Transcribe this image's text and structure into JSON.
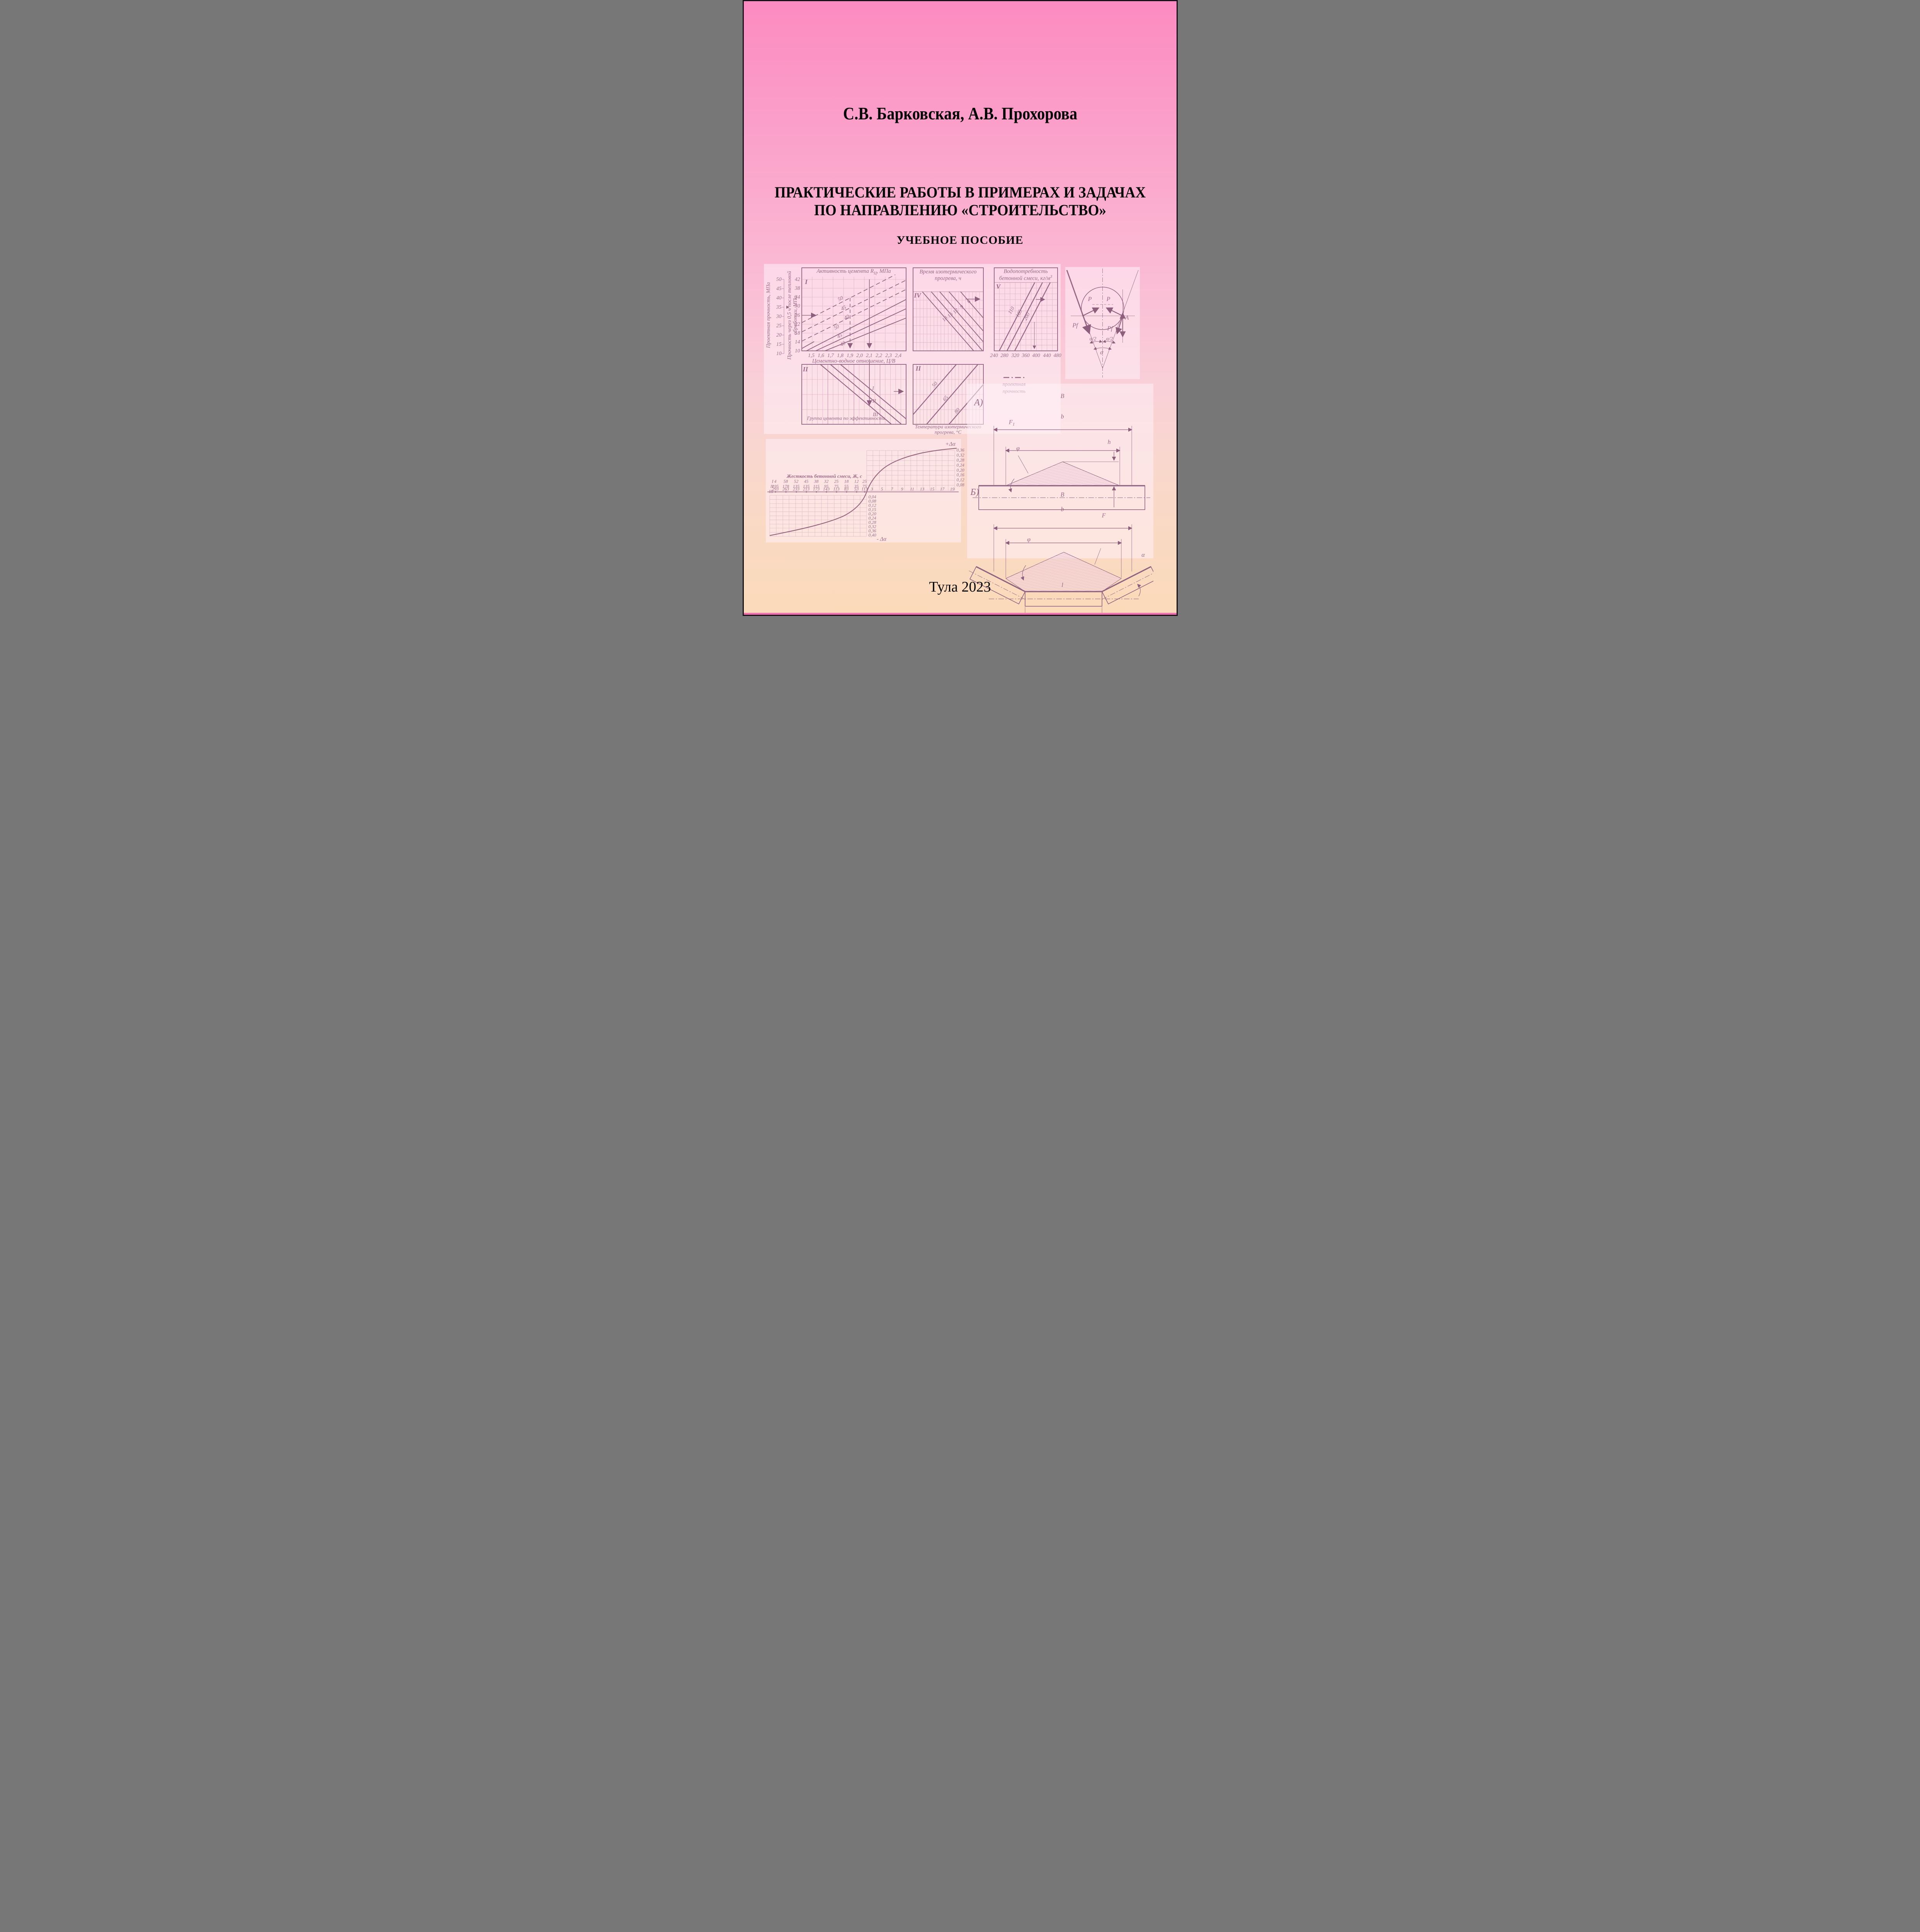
{
  "page": {
    "authors": "С.В. Барковская, А.В. Прохорова",
    "title1": "ПРАКТИЧЕСКИЕ РАБОТЫ В ПРИМЕРАХ И ЗАДАЧАХ",
    "title2": "ПО НАПРАВЛЕНИЮ «СТРОИТЕЛЬСТВО»",
    "subtitle": "УЧЕБНОЕ ПОСОБИЕ",
    "imprint": "Тула 2023"
  },
  "nomogram": {
    "title_activity_pre": "Активность цемента R",
    "title_activity_sub": "Ц",
    "title_activity_post": ", МПа",
    "axis_design_strength": "Проектная прочность, МПа",
    "axis_heat_l1": "Прочность через 0,5 ч после тепловой",
    "axis_heat_l2": "обработки, МПа",
    "scale1": [
      "50",
      "45",
      "40",
      "35",
      "30",
      "25",
      "20",
      "15",
      "10"
    ],
    "scale2": [
      "42",
      "38",
      "34",
      "30",
      "26",
      "22",
      "18",
      "14",
      "10"
    ],
    "cv_ticks": [
      "1,5",
      "1,6",
      "1,7",
      "1,8",
      "1,9",
      "2,0",
      "2,1",
      "2,2",
      "2,3",
      "2,4"
    ],
    "cv_title": "Цементно-водное отношение, Ц/В",
    "q1_label": "I",
    "q1_lines": [
      "50",
      "45",
      "40",
      "50",
      "45",
      "40"
    ],
    "q2_label": "II",
    "q2_lines": [
      "I",
      "II",
      "III"
    ],
    "q2_title": "Группа цемента по эффективности",
    "q4_label": "IV",
    "q4_title_l1": "Время изотермического",
    "q4_title_l2": "прогрева, ч",
    "q4_lines": [
      "18",
      "15",
      "12",
      "9",
      "6"
    ],
    "qt_label": "II",
    "qt_lines": [
      "50",
      "65",
      "80"
    ],
    "qt_title_l1": "Температура изотермического",
    "qt_title_l2": "прогрева, °С",
    "qv_label": "V",
    "qv_title_l1": "Водопотребность",
    "qv_title_l2": "бетонной смеси, кг/м",
    "qv_title_sup": "3",
    "qv_lines": [
      "110",
      "185",
      "200"
    ],
    "qv_ticks": [
      "240",
      "280",
      "320",
      "360",
      "400",
      "440",
      "480"
    ],
    "legend_l1": "проектная",
    "legend_l2": "прочность"
  },
  "forces": {
    "p_left": "P",
    "p_right": "P",
    "pf_left": "Pf",
    "pf_right": "Pf",
    "point_a": "A",
    "half_left": "α/2",
    "half_right": "α/2",
    "alpha": "α"
  },
  "belt": {
    "label_a": "А)",
    "label_b": "Б)",
    "flat": {
      "dim_B": "B",
      "dim_b": "b",
      "area_pre": "F",
      "area_sub": "1",
      "phi": "φ",
      "height": "h"
    },
    "trough": {
      "dim_B": "B",
      "dim_b": "b",
      "area": "F",
      "phi": "φ",
      "alpha": "α",
      "length": "l"
    }
  },
  "stiffness": {
    "plus": "+Δα",
    "minus": "- Δα",
    "header": "Жесткость бетонной смеси, Ж, с",
    "row_labels": [
      "I",
      "II",
      "III"
    ],
    "row1": [
      "4",
      "58",
      "52",
      "45",
      "38",
      "32",
      "25",
      "18",
      "12",
      "25"
    ],
    "row2": [
      "195",
      "178",
      "135",
      "135",
      "115",
      "95",
      "75",
      "55",
      "35",
      "75"
    ],
    "row3": [
      "293",
      "263",
      "233",
      "213",
      "173",
      "143",
      "113",
      "83",
      "53",
      "113"
    ],
    "x_right": [
      "3",
      "5",
      "7",
      "9",
      "11",
      "13",
      "15",
      "17",
      "19"
    ],
    "y_plus": [
      "0,36",
      "0,32",
      "0,28",
      "0,24",
      "0,20",
      "0,16",
      "0,12",
      "0,08"
    ],
    "y_minus": [
      "0,04",
      "0,08",
      "0,12",
      "0,15",
      "0,20",
      "0,24",
      "0,28",
      "0,32",
      "0,36",
      "0,40"
    ]
  },
  "chart_data": [
    {
      "type": "line",
      "quadrant": "I",
      "title": "Активность цемента Rц, МПа",
      "xlabel": "Цементно-водное отношение, Ц/В",
      "x_ticks": [
        1.5,
        1.6,
        1.7,
        1.8,
        1.9,
        2.0,
        2.1,
        2.2,
        2.3,
        2.4
      ],
      "y_axis_left": {
        "label": "Проектная прочность, МПа",
        "ticks": [
          50,
          45,
          40,
          35,
          30,
          25,
          20,
          15,
          10
        ]
      },
      "y_axis_right": {
        "label": "Прочность через 0,5 ч после тепловой обработки, МПа",
        "ticks": [
          42,
          38,
          34,
          30,
          26,
          22,
          18,
          14,
          10
        ]
      },
      "isolines_cement_activity": [
        50,
        45,
        40,
        50,
        45,
        40
      ]
    },
    {
      "type": "line",
      "quadrant": "II",
      "title": "Группа цемента по эффективности",
      "isolines": [
        "I",
        "II",
        "III"
      ]
    },
    {
      "type": "line",
      "quadrant": "IV",
      "title": "Время изотермического прогрева, ч",
      "isolines": [
        18,
        15,
        12,
        9,
        6
      ]
    },
    {
      "type": "line",
      "quadrant": "II",
      "title": "Температура изотермического прогрева, °С",
      "isolines": [
        50,
        65,
        80
      ]
    },
    {
      "type": "line",
      "quadrant": "V",
      "title": "Водопотребность бетонной смеси, кг/м³",
      "x_ticks": [
        240,
        280,
        320,
        360,
        400,
        440,
        480
      ],
      "isolines": [
        110,
        185,
        200
      ],
      "legend": "проектная прочность"
    },
    {
      "type": "line",
      "title": "Жесткость бетонной смеси, Ж, с",
      "ylabel_positive": "+Δα",
      "ylabel_negative": "-Δα",
      "scale_rows": {
        "I": [
          4,
          58,
          52,
          45,
          38,
          32,
          25,
          18,
          12,
          25
        ],
        "II": [
          195,
          178,
          135,
          135,
          115,
          95,
          75,
          55,
          35,
          75
        ],
        "III": [
          293,
          263,
          233,
          213,
          173,
          143,
          113,
          83,
          53,
          113
        ]
      },
      "x_right_ticks": [
        3,
        5,
        7,
        9,
        11,
        13,
        15,
        17,
        19
      ],
      "y_plus_ticks": [
        0.36,
        0.32,
        0.28,
        0.24,
        0.2,
        0.16,
        0.12,
        0.08
      ],
      "y_minus_ticks": [
        0.04,
        0.08,
        0.12,
        0.15,
        0.2,
        0.24,
        0.28,
        0.32,
        0.36,
        0.4
      ],
      "curve_positive": [
        [
          3,
          0.09
        ],
        [
          5,
          0.17
        ],
        [
          7,
          0.22
        ],
        [
          9,
          0.26
        ],
        [
          11,
          0.285
        ],
        [
          13,
          0.3
        ],
        [
          15,
          0.315
        ],
        [
          17,
          0.335
        ],
        [
          19,
          0.355
        ]
      ],
      "curve_negative_at_columns": [
        -0.4,
        -0.37,
        -0.345,
        -0.315,
        -0.28,
        -0.245,
        -0.2,
        -0.15,
        -0.09,
        -0.03
      ]
    }
  ]
}
